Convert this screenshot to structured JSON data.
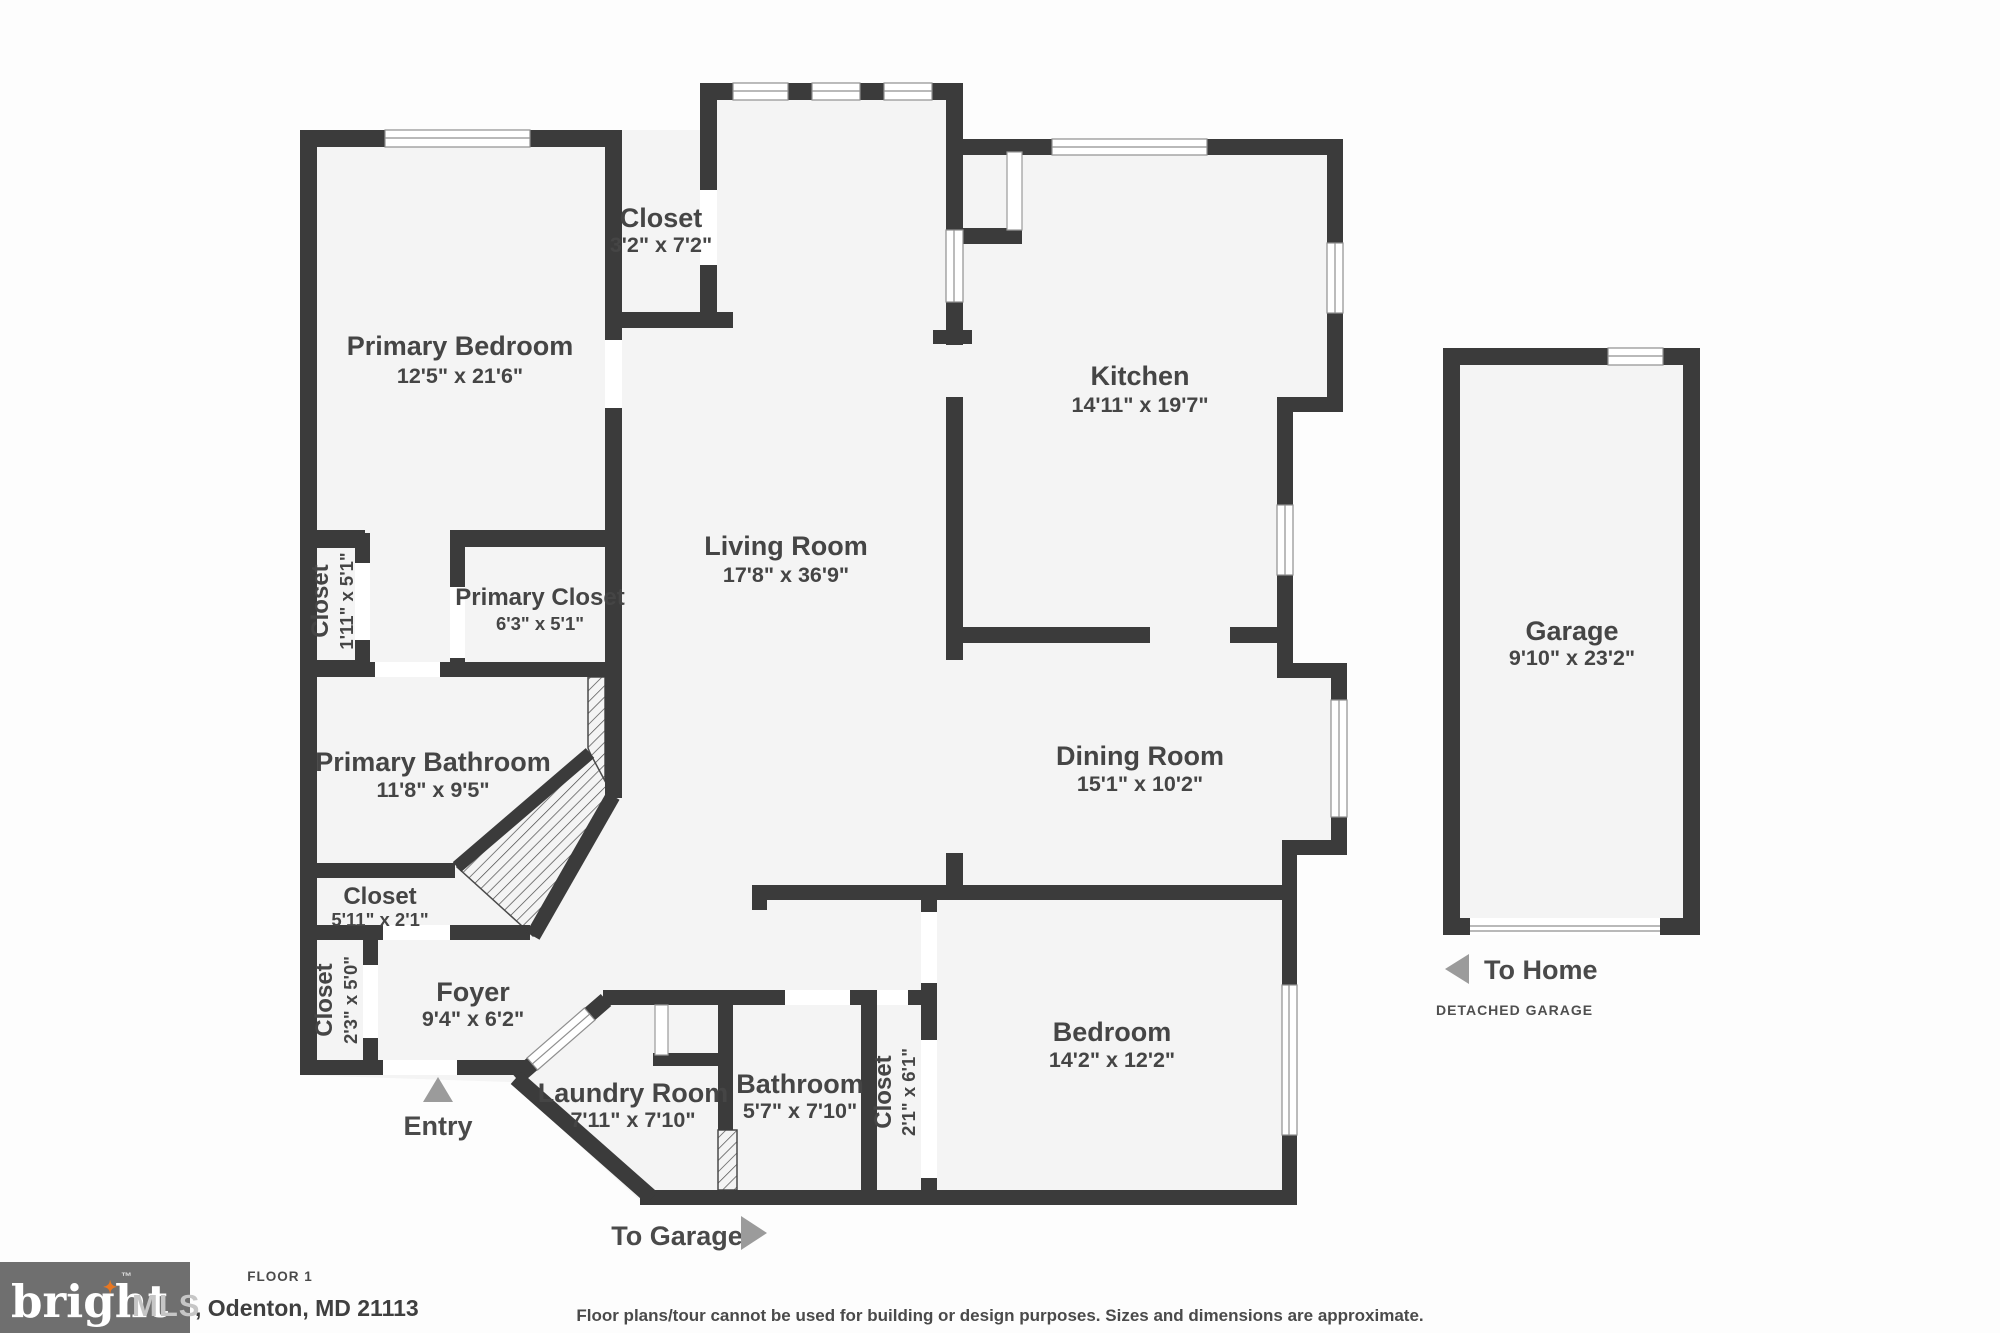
{
  "rooms": [
    {
      "id": "primary-bedroom",
      "name": "Primary Bedroom",
      "dims": "12'5\" x 21'6\""
    },
    {
      "id": "hall-closet",
      "name": "Closet",
      "dims": "3'2\" x 7'2\""
    },
    {
      "id": "kitchen",
      "name": "Kitchen",
      "dims": "14'11\" x 19'7\""
    },
    {
      "id": "living-room",
      "name": "Living Room",
      "dims": "17'8\" x 36'9\""
    },
    {
      "id": "primary-closet",
      "name": "Primary Closet",
      "dims": "6'3\" x 5'1\""
    },
    {
      "id": "closet-1-11",
      "name": "Closet",
      "dims": "1'11\" x 5'1\""
    },
    {
      "id": "primary-bathroom",
      "name": "Primary Bathroom",
      "dims": "11'8\" x 9'5\""
    },
    {
      "id": "dining-room",
      "name": "Dining Room",
      "dims": "15'1\" x 10'2\""
    },
    {
      "id": "closet-5-11",
      "name": "Closet",
      "dims": "5'11\" x 2'1\""
    },
    {
      "id": "closet-2-3",
      "name": "Closet",
      "dims": "2'3\" x 5'0\""
    },
    {
      "id": "foyer",
      "name": "Foyer",
      "dims": "9'4\" x 6'2\""
    },
    {
      "id": "laundry-room",
      "name": "Laundry Room",
      "dims": "7'11\" x 7'10\""
    },
    {
      "id": "bathroom",
      "name": "Bathroom",
      "dims": "5'7\" x 7'10\""
    },
    {
      "id": "closet-2-1",
      "name": "Closet",
      "dims": "2'1\" x 6'1\""
    },
    {
      "id": "bedroom",
      "name": "Bedroom",
      "dims": "14'2\" x 12'2\""
    },
    {
      "id": "garage",
      "name": "Garage",
      "dims": "9'10\" x 23'2\""
    }
  ],
  "annotations": {
    "entry": "Entry",
    "to_garage": "To Garage",
    "to_home": "To Home",
    "detached_garage": "DETACHED GARAGE"
  },
  "footer": {
    "floor_label": "FLOOR 1",
    "address": ", Odenton, MD 21113",
    "disclaimer": "Floor plans/tour cannot be used for building or design purposes. Sizes and dimensions are approximate."
  },
  "logo": {
    "brand": "bright",
    "suffix": "MLS",
    "tm": "™",
    "star": "✦"
  },
  "colors": {
    "wall": "#3b3b3b",
    "room_fill": "#f4f4f4",
    "label_text": "#454545",
    "arrow": "#9b9b9b",
    "logo_bg": "#6f6f6f",
    "logo_star": "#e87722"
  }
}
